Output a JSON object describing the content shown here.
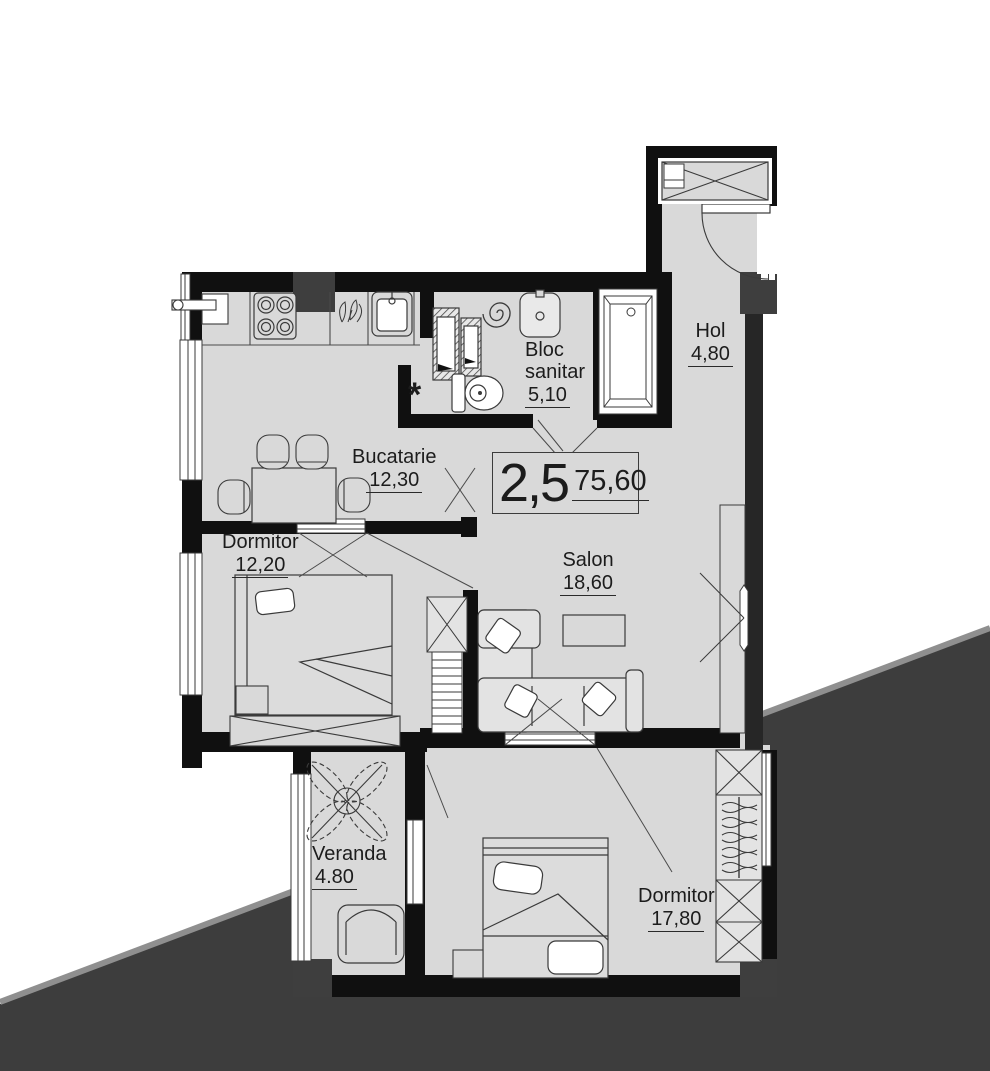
{
  "plan": {
    "title_box": {
      "rooms_count": "2,5",
      "total_area": "75,60"
    },
    "rooms": {
      "bucatarie": {
        "name": "Bucatarie",
        "area": "12,30"
      },
      "dormitor_mic": {
        "name": "Dormitor",
        "area": "12,20"
      },
      "bloc_sanitar": {
        "name_line1": "Bloc",
        "name_line2": "sanitar",
        "area": "5,10"
      },
      "hol": {
        "name": "Hol",
        "area": "4,80"
      },
      "salon": {
        "name": "Salon",
        "area": "18,60"
      },
      "veranda": {
        "name": "Veranda",
        "area": "4.80"
      },
      "dormitor_mare": {
        "name": "Dormitor",
        "area": "17,80"
      }
    },
    "annotations": {
      "shaft_marker": "*"
    },
    "colors": {
      "floor": "#d9d9d9",
      "wall": "#101010",
      "pier": "#3e3e3e",
      "outside_area": "#3d3d3d",
      "outside_edge": "#8f8f8f",
      "furniture_line": "#4a4a4a"
    }
  }
}
